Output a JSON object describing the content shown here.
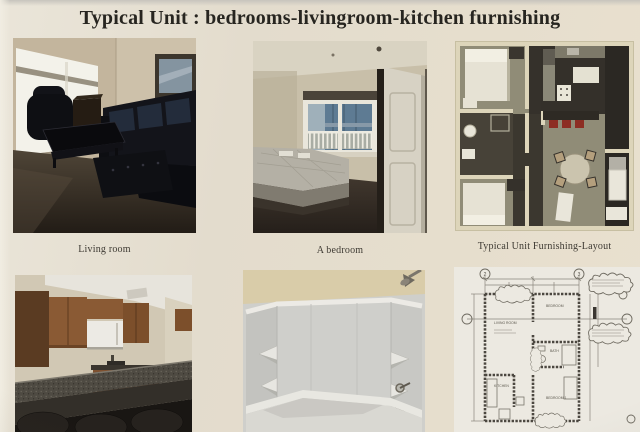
{
  "page": {
    "title": "Typical Unit : bedrooms-livingroom-kitchen furnishing"
  },
  "captions": {
    "living_room": "Living room",
    "bedroom": "A bedroom",
    "layout": "Typical Unit Furnishing-Layout"
  },
  "cad_plan": {
    "grid_bubble_left": "2",
    "grid_bubble_right": "3",
    "labels": {
      "living": "LIVING ROOM",
      "bedroom_upper": "BEDROOM",
      "bath": "BATH",
      "kitchen": "KITCHEN",
      "bedroom_lower": "BEDROOM 1"
    }
  },
  "colors": {
    "paper": "#e5decf",
    "title_ink": "#272520",
    "carpet_dark": "#2c251e",
    "wall_beige": "#c8bfa9",
    "cabinet_wood": "#8a5a34",
    "granite_bar": "#4e4a42",
    "stool_red": "#8d2d23",
    "layout_carpet_olive": "#908c77",
    "layout_wall_cream": "#ddd5ba",
    "blueprint_ink": "#6e6a60"
  }
}
